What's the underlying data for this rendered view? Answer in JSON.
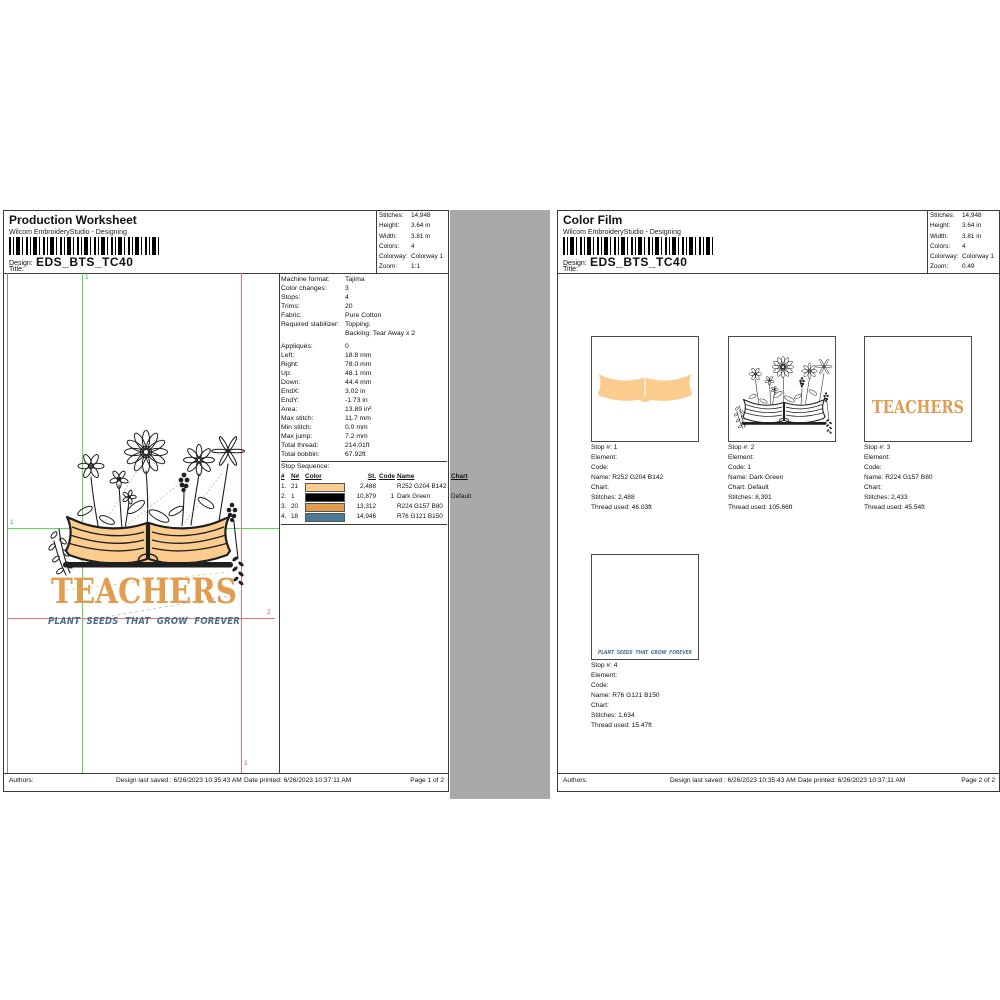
{
  "artwork": {
    "teachers": "TEACHERS",
    "subtitle": "PLANT SEEDS THAT GROW FOREVER"
  },
  "colors": {
    "thread_tan": "#FCCC8E",
    "thread_dark": "#000000",
    "thread_orange": "#E09D50",
    "thread_blue": "#4C7996",
    "guide_green": "#5BDB5B",
    "guide_red": "#F26C6C"
  },
  "pages": {
    "left": {
      "header": {
        "title": "Production Worksheet",
        "app": "Wilcom EmbroideryStudio - Designing",
        "design_label": "Design:",
        "design_code": "EDS_BTS_TC40",
        "title_label": "Title:"
      },
      "info": {
        "rows": [
          {
            "label": "Stitches:",
            "value": "14,948"
          },
          {
            "label": "Height:",
            "value": "3.64 in"
          },
          {
            "label": "Width:",
            "value": "3.81 in"
          },
          {
            "label": "Colors:",
            "value": "4"
          },
          {
            "label": "Colorway:",
            "value": "Colorway 1"
          },
          {
            "label": "Zoom:",
            "value": "1:1"
          }
        ]
      },
      "details": {
        "rows": [
          {
            "label": "Machine format:",
            "value": "Tajima"
          },
          {
            "label": "Color changes:",
            "value": "3"
          },
          {
            "label": "Stops:",
            "value": "4"
          },
          {
            "label": "Trims:",
            "value": "20"
          },
          {
            "label": "Fabric:",
            "value": "Pure Cotton"
          },
          {
            "label": "Required stabilizer:",
            "value": "Topping:"
          },
          {
            "label": "",
            "value": "Backing: Tear Away x 2"
          },
          {
            "label": "Appliqués:",
            "value": "0"
          },
          {
            "label": "Left:",
            "value": "18.8 mm"
          },
          {
            "label": "Right:",
            "value": "78.0 mm"
          },
          {
            "label": "Up:",
            "value": "48.1 mm"
          },
          {
            "label": "Down:",
            "value": "44.4 mm"
          },
          {
            "label": "EndX:",
            "value": "3.02 in"
          },
          {
            "label": "EndY:",
            "value": "-1.73 in"
          },
          {
            "label": "Area:",
            "value": "13.89 in²"
          },
          {
            "label": "Max stitch:",
            "value": "11.7 mm"
          },
          {
            "label": "Min stitch:",
            "value": "0.0 mm"
          },
          {
            "label": "Max jump:",
            "value": "7.2 mm"
          },
          {
            "label": "Total thread:",
            "value": "214.01ft"
          },
          {
            "label": "Total bobbin:",
            "value": "67.92ft"
          }
        ]
      },
      "stop_sequence": {
        "heading": "Stop Sequence:",
        "columns": [
          "#",
          "N#",
          "Color",
          "St.",
          "Code",
          "Name",
          "Chart"
        ],
        "rows": [
          {
            "num": "1.",
            "n": "21",
            "color": "#FCCC8E",
            "st": "2,488",
            "code": "",
            "name": "R252 G204 B142",
            "chart": ""
          },
          {
            "num": "2.",
            "n": "1",
            "color": "#000000",
            "st": "10,879",
            "code": "1",
            "name": "Dark Green",
            "chart": "Default"
          },
          {
            "num": "3.",
            "n": "20",
            "color": "#E09D50",
            "st": "13,312",
            "code": "",
            "name": "R224 G157 B80",
            "chart": ""
          },
          {
            "num": "4.",
            "n": "18",
            "color": "#4C7996",
            "st": "14,946",
            "code": "",
            "name": "R76 G121 B150",
            "chart": ""
          }
        ]
      },
      "guides": {
        "marker_v1": "1",
        "marker_h1": "1",
        "marker_v2": "2",
        "marker_h2": "2"
      },
      "footer": {
        "authors": "Authors:",
        "saved": "Design last saved : 6/26/2023 10:35:43 AM",
        "printed": "Date printed: 6/26/2023 10:37:11 AM",
        "page": "Page 1 of 2"
      }
    },
    "right": {
      "header": {
        "title": "Color Film",
        "app": "Wilcom EmbroideryStudio - Designing",
        "design_label": "Design:",
        "design_code": "EDS_BTS_TC40",
        "title_label": "Title:"
      },
      "info": {
        "rows": [
          {
            "label": "Stitches:",
            "value": "14,948"
          },
          {
            "label": "Height:",
            "value": "3.64 in"
          },
          {
            "label": "Width:",
            "value": "3.81 in"
          },
          {
            "label": "Colors:",
            "value": "4"
          },
          {
            "label": "Colorway:",
            "value": "Colorway 1"
          },
          {
            "label": "Zoom:",
            "value": "0.49"
          }
        ]
      },
      "films": [
        {
          "caption": {
            "stop": "Stop #: 1",
            "element": "Element:",
            "code": "Code:",
            "name": "Name: R252 G204 B142",
            "chart": "Chart:",
            "stitches": "Stitches: 2,488",
            "thread": "Thread used: 46.03ft"
          }
        },
        {
          "caption": {
            "stop": "Stop #: 2",
            "element": "Element:",
            "code": "Code: 1",
            "name": "Name: Dark Green",
            "chart": "Chart: Default",
            "stitches": "Stitches: 8,391",
            "thread": "Thread used: 105.66ft"
          }
        },
        {
          "caption": {
            "stop": "Stop #: 3",
            "element": "Element:",
            "code": "Code:",
            "name": "Name: R224 G157 B80",
            "chart": "Chart:",
            "stitches": "Stitches: 2,433",
            "thread": "Thread used: 45.54ft"
          }
        },
        {
          "caption": {
            "stop": "Stop #: 4",
            "element": "Element:",
            "code": "Code:",
            "name": "Name: R76 G121 B150",
            "chart": "Chart:",
            "stitches": "Stitches: 1,634",
            "thread": "Thread used: 15.47ft"
          }
        }
      ],
      "footer": {
        "authors": "Authors:",
        "saved": "Design last saved : 6/26/2023 10:35:43 AM",
        "printed": "Date printed: 6/26/2023 10:37:11 AM",
        "page": "Page 2 of 2"
      }
    }
  }
}
